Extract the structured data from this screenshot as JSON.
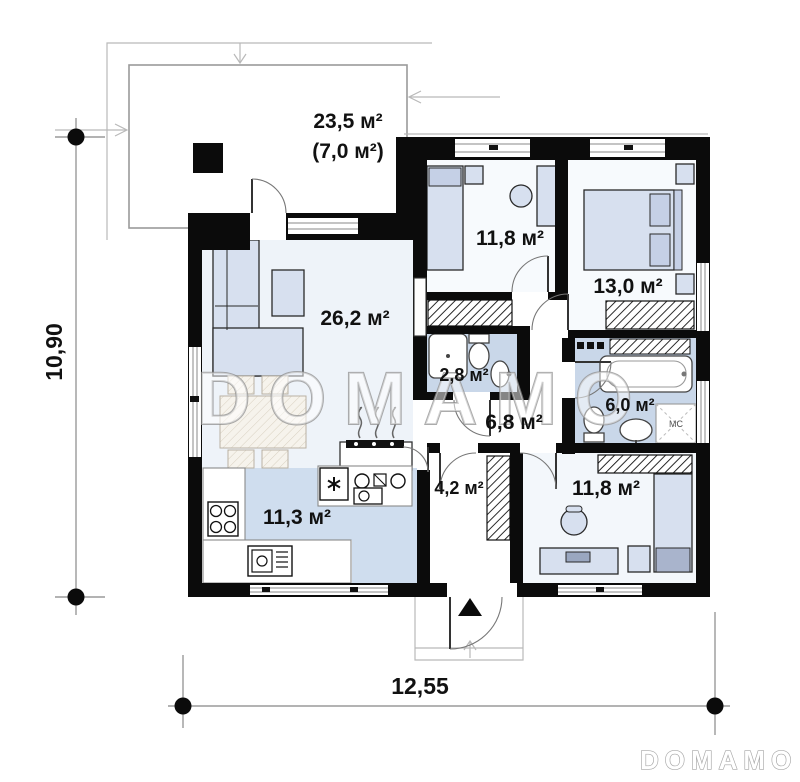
{
  "watermark_text": "DOMAMO",
  "brand_logo": "DOMAMO",
  "dimensions": {
    "overall_width": "12,55",
    "overall_height": "10,90"
  },
  "areas": {
    "terrace": "23,5 м²",
    "terrace_secondary": "(7,0 м²)",
    "bedroom_top": "11,8 м²",
    "bedroom_right": "13,0 м²",
    "living_room": "26,2 м²",
    "bathroom_small": "2,8 м²",
    "hallway": "6,8 м²",
    "bathroom_large": "6,0 м²",
    "entrance_hall": "4,2 м²",
    "kitchen": "11,3 м²",
    "bedroom_bottom": "11,8 м²"
  },
  "labels": {
    "washing_machine": "МС"
  },
  "colors": {
    "wall": "#0b0b0b",
    "room_tint": "#eef3f9",
    "wet_room": "#c9d7e9",
    "kitchen_floor": "#cfddee",
    "furniture": "#d7e0ef",
    "watermark_outline": "#8f8f8f"
  }
}
